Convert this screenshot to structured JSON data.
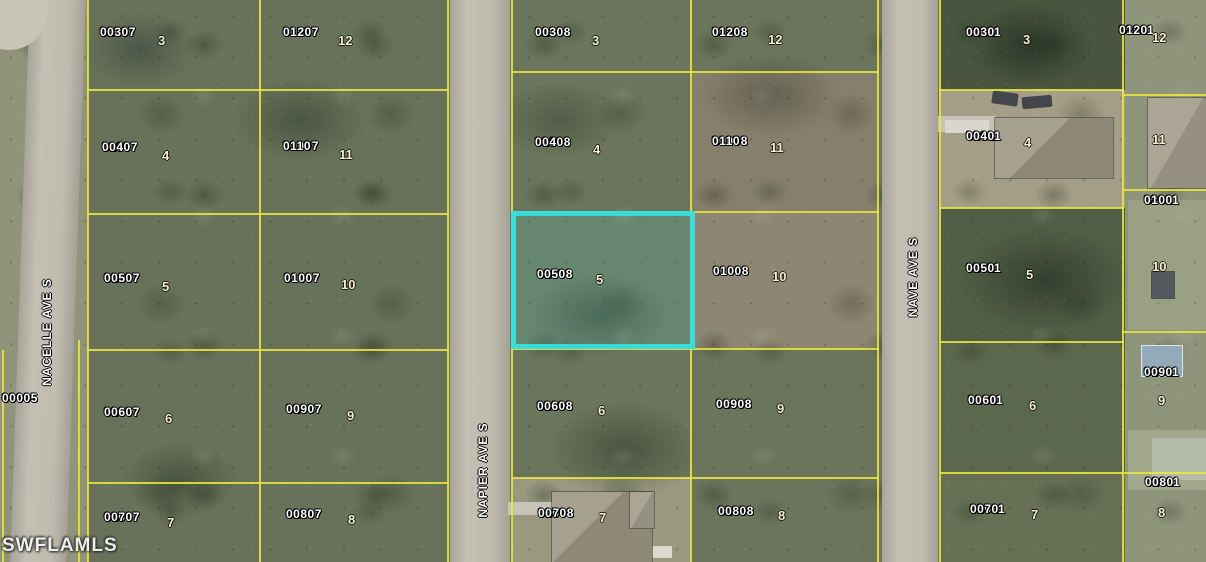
{
  "map": {
    "watermark": "SWFLAMLS",
    "colors": {
      "boundary": "#e9e63f",
      "highlight": "#35dfde",
      "road": "#c1bdb1"
    },
    "streets": [
      {
        "name": "NACELLE AVE S",
        "x": 47,
        "y": 332
      },
      {
        "name": "NAPIER AVE S",
        "x": 483,
        "y": 470
      },
      {
        "name": "NAVE AVE S",
        "x": 913,
        "y": 277
      }
    ],
    "parcels": [
      {
        "id": "01007",
        "code": "0030",
        "lot": "3",
        "x": 100,
        "y": 26,
        "lot_x": 158,
        "lot_y": 34,
        "highlighted": false
      },
      {
        "id": "01007",
        "code": "0120",
        "lot": "12",
        "x": 283,
        "y": 26,
        "lot_x": 338,
        "lot_y": 34,
        "highlighted": false
      },
      {
        "id": "01008",
        "code": "0030",
        "lot": "3",
        "x": 535,
        "y": 26,
        "lot_x": 592,
        "lot_y": 34,
        "highlighted": false
      },
      {
        "id": "01008",
        "code": "0120",
        "lot": "12",
        "x": 712,
        "y": 26,
        "lot_x": 768,
        "lot_y": 33,
        "highlighted": false
      },
      {
        "id": "02011",
        "code": "0030",
        "lot": "3",
        "x": 966,
        "y": 26,
        "lot_x": 1023,
        "lot_y": 33,
        "highlighted": false
      },
      {
        "id": "02011",
        "code": "0120",
        "lot": "12",
        "x": 1119,
        "y": 24,
        "lot_x": 1152,
        "lot_y": 31,
        "highlighted": false
      },
      {
        "id": "01007",
        "code": "0040",
        "lot": "4",
        "x": 102,
        "y": 141,
        "lot_x": 162,
        "lot_y": 149,
        "highlighted": false
      },
      {
        "id": "01007",
        "code": "0110",
        "lot": "11",
        "x": 283,
        "y": 140,
        "lot_x": 339,
        "lot_y": 148,
        "highlighted": false
      },
      {
        "id": "01008",
        "code": "0040",
        "lot": "4",
        "x": 535,
        "y": 136,
        "lot_x": 593,
        "lot_y": 143,
        "highlighted": false
      },
      {
        "id": "01008",
        "code": "0110",
        "lot": "11",
        "x": 712,
        "y": 135,
        "lot_x": 770,
        "lot_y": 141,
        "highlighted": false
      },
      {
        "id": "02011",
        "code": "0040",
        "lot": "4",
        "x": 966,
        "y": 130,
        "lot_x": 1024,
        "lot_y": 136,
        "highlighted": false
      },
      {
        "id": "",
        "code": "",
        "lot": "11",
        "x": 0,
        "y": 0,
        "lot_x": 1152,
        "lot_y": 133,
        "highlighted": false
      },
      {
        "id": "01007",
        "code": "0050",
        "lot": "5",
        "x": 104,
        "y": 272,
        "lot_x": 162,
        "lot_y": 280,
        "highlighted": false
      },
      {
        "id": "01007",
        "code": "0100",
        "lot": "10",
        "x": 284,
        "y": 272,
        "lot_x": 341,
        "lot_y": 278,
        "highlighted": false
      },
      {
        "id": "01008",
        "code": "0050",
        "lot": "5",
        "x": 537,
        "y": 268,
        "lot_x": 596,
        "lot_y": 273,
        "highlighted": true
      },
      {
        "id": "01008",
        "code": "0100",
        "lot": "10",
        "x": 713,
        "y": 265,
        "lot_x": 772,
        "lot_y": 270,
        "highlighted": false
      },
      {
        "id": "02011",
        "code": "0050",
        "lot": "5",
        "x": 966,
        "y": 262,
        "lot_x": 1026,
        "lot_y": 268,
        "highlighted": false
      },
      {
        "id": "02011",
        "code": "0100",
        "lot": "10",
        "x": 1144,
        "y": 194,
        "lot_x": 1152,
        "lot_y": 260,
        "highlighted": false
      },
      {
        "id": "01007",
        "code": "0060",
        "lot": "6",
        "x": 104,
        "y": 406,
        "lot_x": 165,
        "lot_y": 412,
        "highlighted": false
      },
      {
        "id": "01007",
        "code": "0090",
        "lot": "9",
        "x": 286,
        "y": 403,
        "lot_x": 347,
        "lot_y": 409,
        "highlighted": false
      },
      {
        "id": "01008",
        "code": "0060",
        "lot": "6",
        "x": 537,
        "y": 400,
        "lot_x": 598,
        "lot_y": 404,
        "highlighted": false
      },
      {
        "id": "01008",
        "code": "0090",
        "lot": "9",
        "x": 716,
        "y": 398,
        "lot_x": 777,
        "lot_y": 402,
        "highlighted": false
      },
      {
        "id": "02011",
        "code": "0060",
        "lot": "6",
        "x": 968,
        "y": 394,
        "lot_x": 1029,
        "lot_y": 399,
        "highlighted": false
      },
      {
        "id": "02011",
        "code": "0090",
        "lot": "9",
        "x": 1144,
        "y": 366,
        "lot_x": 1158,
        "lot_y": 394,
        "highlighted": false
      },
      {
        "id": "01007",
        "code": "0070",
        "lot": "7",
        "x": 104,
        "y": 511,
        "lot_x": 167,
        "lot_y": 516,
        "highlighted": false
      },
      {
        "id": "01007",
        "code": "0080",
        "lot": "8",
        "x": 286,
        "y": 508,
        "lot_x": 348,
        "lot_y": 513,
        "highlighted": false
      },
      {
        "id": "01008",
        "code": "0070",
        "lot": "7",
        "x": 538,
        "y": 507,
        "lot_x": 599,
        "lot_y": 511,
        "highlighted": false
      },
      {
        "id": "01008",
        "code": "0080",
        "lot": "8",
        "x": 718,
        "y": 505,
        "lot_x": 778,
        "lot_y": 509,
        "highlighted": false
      },
      {
        "id": "02011",
        "code": "0070",
        "lot": "7",
        "x": 970,
        "y": 503,
        "lot_x": 1031,
        "lot_y": 508,
        "highlighted": false
      },
      {
        "id": "02011",
        "code": "0080",
        "lot": "8",
        "x": 1145,
        "y": 476,
        "lot_x": 1158,
        "lot_y": 506,
        "highlighted": false
      },
      {
        "id": "00005",
        "code": "0000",
        "lot": "",
        "x": 2,
        "y": 392,
        "lot_x": 0,
        "lot_y": 0,
        "highlighted": false
      }
    ]
  }
}
